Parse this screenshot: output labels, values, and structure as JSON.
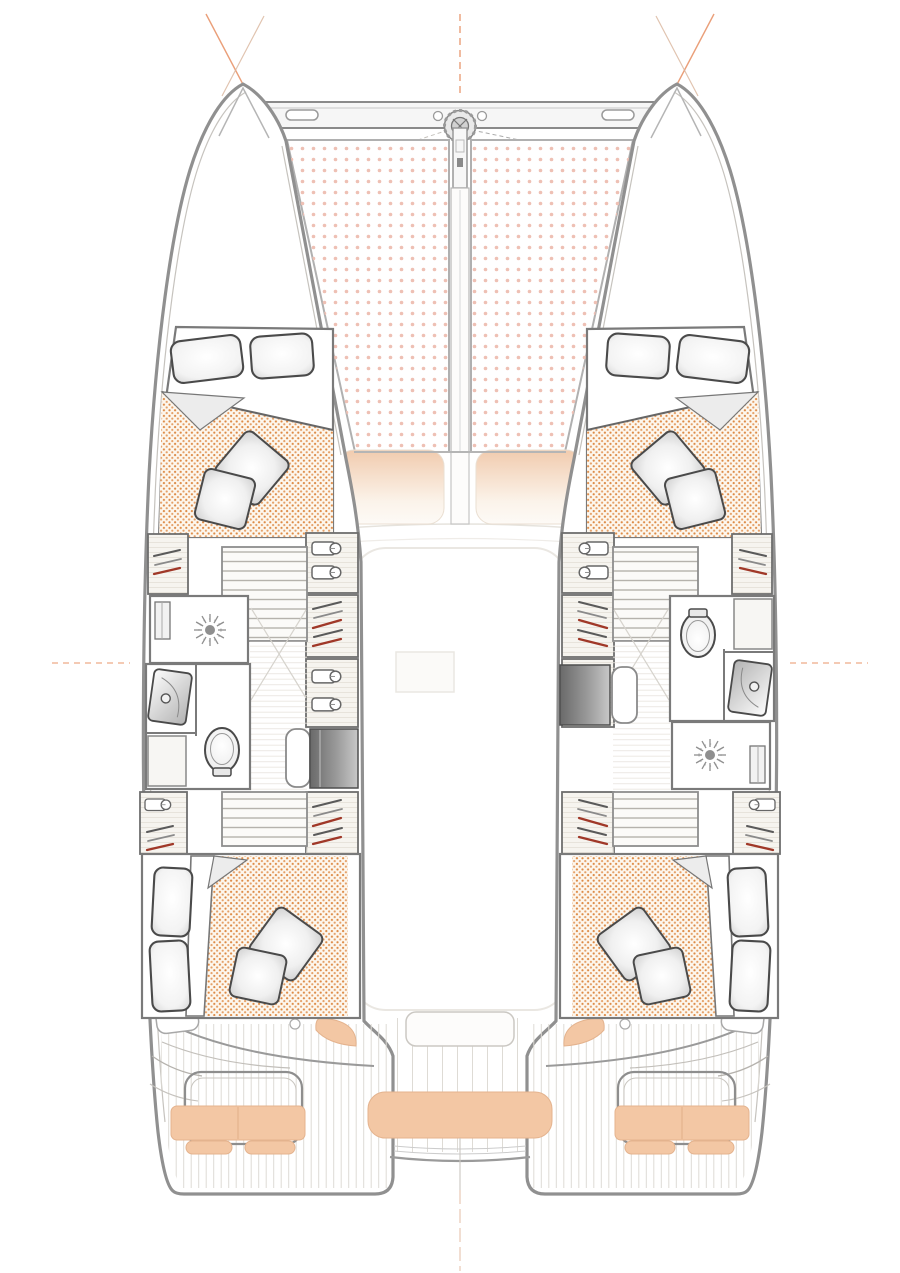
{
  "structure": {
    "type": "catamaran-lower-deck-floor-plan",
    "view": "top-down, bow at top",
    "hulls": [
      "port",
      "starboard"
    ],
    "cabins": [
      "forward-port",
      "forward-starboard",
      "aft-port",
      "aft-starboard"
    ],
    "bathrooms": [
      "port-midship (shower, sink, toilet)",
      "starboard-midship (toilet, sink, shower)"
    ],
    "desks": [
      "port",
      "starboard"
    ],
    "trampoline_panels": 2,
    "forward_cockpit_cushions": 2,
    "aft_cockpit_cushions": [
      "port-bench",
      "center-bench",
      "starboard-bench",
      "port-ovals",
      "starboard-ovals",
      "corner-pads"
    ]
  },
  "icons": {
    "windlass": "windlass-icon",
    "shower_drain": "shower-drain-icon",
    "toilet": "toilet-icon",
    "sink": "sink-icon",
    "clothes_hanger": "hanger-icon",
    "shirt_on_hanger": "shirt-hanger-icon",
    "companionway_steps": "stairs-icon",
    "pillow": "pillow-icon",
    "rigging": "rigging-line",
    "anchor_bridle": "anchor-bridle-line"
  },
  "colors": {
    "hull_outline": "#909090",
    "inner_line": "#c6c3be",
    "wall": "#7a7a7a",
    "cabinet_stroke": "#6e6e6e",
    "trampoline_dot": "#eec0b4",
    "mattress_dot": "#dd8a45",
    "mattress_bg": "#fdf7ee",
    "cushion": "#f3c7a4",
    "cushion_edge": "#e4b38e",
    "rig_accent": "#e8956a",
    "wood_light": "#f6f4ef",
    "wood_grain": "#e7e3db",
    "floor_grain": "#e9e5df",
    "plank_line": "#dedbd5",
    "fixture": "#4a4a4a",
    "fixture_mid": "#8f8f8f",
    "hanger_red": "#a03828",
    "hanger_gray": "#5a5a5a",
    "ghost": "#eae7e2",
    "step_line": "#b5b2ac",
    "pillow_edge": "#4a4a4a"
  }
}
